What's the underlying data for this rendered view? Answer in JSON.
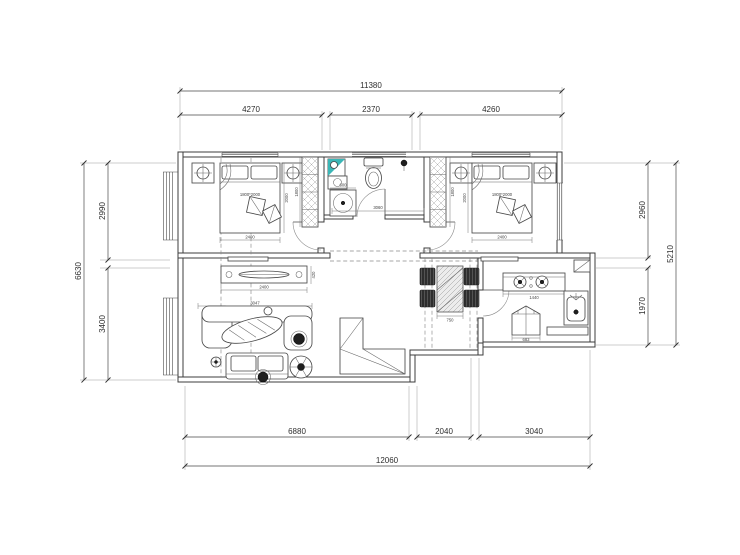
{
  "document": {
    "type": "residential floor plan"
  },
  "colors": {
    "teal": "#3AB6B6",
    "line": "#3A3A3A",
    "dim_text": "#2E2E2E"
  },
  "dims": {
    "top": {
      "total": "11380",
      "seg1": "4270",
      "seg2": "2370",
      "seg3": "4260"
    },
    "bottom": {
      "seg1": "6880",
      "seg2": "2040",
      "seg3": "3040",
      "total": "12060"
    },
    "left": {
      "total": "6630",
      "seg1": "2990",
      "seg2": "3400"
    },
    "right": {
      "seg1": "2960",
      "seg2": "1970",
      "total": "5210"
    }
  },
  "labels": {
    "bed_left": "1800*2000",
    "bed_right": "1800*2000",
    "bed_left_width": "2400",
    "bed_left_depth": "2000",
    "wardrobe_left": "1800",
    "bed_right_width": "2400",
    "bed_right_depth": "2000",
    "wardrobe_right": "1800",
    "washer": "600",
    "bath_width": "3060",
    "tv_cabinet_width": "2400",
    "living_width": "3047",
    "tv_cabinet_depth": "420",
    "dining_table": "750",
    "kitchen_counter": "1440",
    "fridge": "683"
  }
}
